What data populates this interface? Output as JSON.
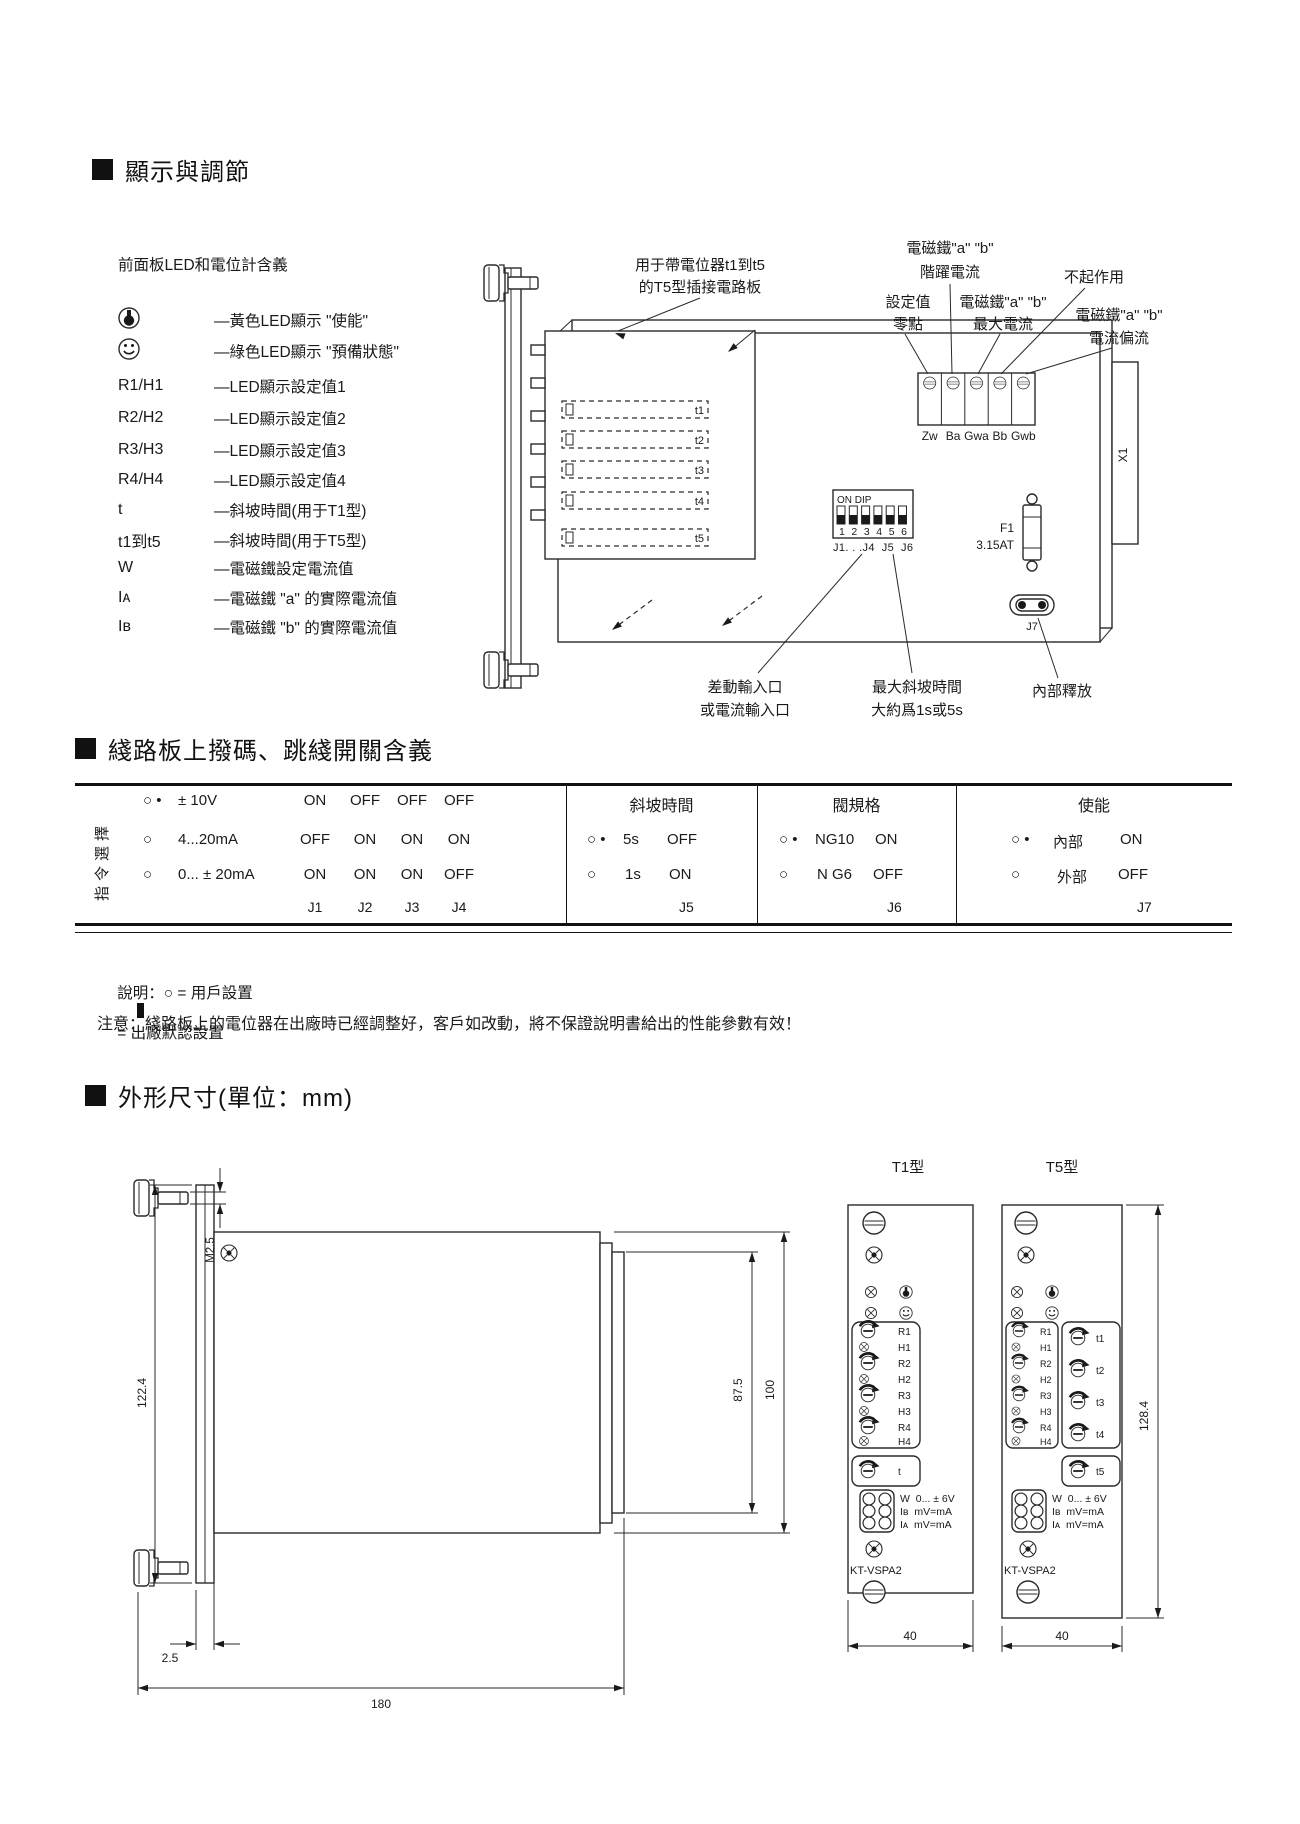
{
  "sections": {
    "display": "顯示與調節",
    "dip": "綫路板上撥碼、跳綫開關含義",
    "dims": "外形尺寸(單位：mm)"
  },
  "legend": {
    "title": "前面板LED和電位計含義",
    "rows": [
      {
        "sym": "",
        "desc": "—黃色LED顯示 \"使能\""
      },
      {
        "sym": "",
        "desc": "—綠色LED顯示 \"預備狀態\""
      },
      {
        "sym": "R1/H1",
        "desc": "—LED顯示設定值1"
      },
      {
        "sym": "R2/H2",
        "desc": "—LED顯示設定值2"
      },
      {
        "sym": "R3/H3",
        "desc": "—LED顯示設定值3"
      },
      {
        "sym": "R4/H4",
        "desc": "—LED顯示設定值4"
      },
      {
        "sym": "t",
        "desc": "—斜坡時間(用于T1型)"
      },
      {
        "sym": "t1到t5",
        "desc": "—斜坡時間(用于T5型)"
      },
      {
        "sym": "W",
        "desc": "—電磁鐵設定電流值"
      },
      {
        "sym": "Iᴀ",
        "desc": "—電磁鐵 \"a\" 的實際電流值"
      },
      {
        "sym": "Iʙ",
        "desc": "—電磁鐵 \"b\" 的實際電流值"
      }
    ]
  },
  "board": {
    "ann": {
      "t5board1": "用于帶電位器t1到t5",
      "t5board2": "的T5型插接電路板",
      "step1": "電磁鐵\"a\" \"b\"",
      "step2": "階躍電流",
      "zero1": "設定值",
      "zero2": "零點",
      "max1": "電磁鐵\"a\" \"b\"",
      "max2": "最大電流",
      "noeffect": "不起作用",
      "bias1": "電磁鐵\"a\" \"b\"",
      "bias2": "電流偏流",
      "input1": "差動輸入口",
      "input2": "或電流輸入口",
      "ramp1": "最大斜坡時間",
      "ramp2": "大約爲1s或5s",
      "release": "內部釋放"
    },
    "pots": [
      "Zw",
      "Ba",
      "Gwa",
      "Bb",
      "Gwb"
    ],
    "dip": {
      "on": "ON DIP",
      "nums": "1 2 3 4 5 6",
      "jumpers": "J1. . .J4  J5  J6"
    },
    "fuse1": "F1",
    "fuse2": "3.15AT",
    "j7": "J7",
    "x1": "X1",
    "tlabels": [
      "t1",
      "t2",
      "t3",
      "t4",
      "t5"
    ]
  },
  "table": {
    "col1": {
      "side": "指令選擇",
      "rows": [
        {
          "m": "○ •",
          "label": "± 10V",
          "v": [
            "ON",
            "OFF",
            "OFF",
            "OFF"
          ]
        },
        {
          "m": "○",
          "label": "4...20mA",
          "v": [
            "OFF",
            "ON",
            "ON",
            "ON"
          ]
        },
        {
          "m": "○",
          "label": "0... ± 20mA",
          "v": [
            "ON",
            "ON",
            "ON",
            "OFF"
          ]
        }
      ],
      "j": [
        "J1",
        "J2",
        "J3",
        "J4"
      ]
    },
    "col2": {
      "header": "斜坡時間",
      "rows": [
        {
          "m": "○ •",
          "label": "5s",
          "v": "OFF"
        },
        {
          "m": "○",
          "label": "1s",
          "v": "ON"
        }
      ],
      "j": "J5"
    },
    "col3": {
      "header": "閥規格",
      "rows": [
        {
          "m": "○ •",
          "label": "NG10",
          "v": "ON"
        },
        {
          "m": "○",
          "label": "N G6",
          "v": "OFF"
        }
      ],
      "j": "J6"
    },
    "col4": {
      "header": "使能",
      "rows": [
        {
          "m": "○ •",
          "label": "內部",
          "v": "ON"
        },
        {
          "m": "○",
          "label": "外部",
          "v": "OFF"
        }
      ],
      "j": "J7"
    }
  },
  "notes": {
    "legend_user": "說明：○ = 用戶設置",
    "legend_default": "= 出廠默認設置",
    "warning": "注意：綫路板上的電位器在出廠時已經調整好，客戶如改動，將不保證說明書給出的性能參數有效！"
  },
  "dims": {
    "side": {
      "h": "122.4",
      "screw": "M2.5",
      "off": "2.5",
      "depth": "180",
      "h1": "87.5",
      "h2": "100"
    },
    "t1": {
      "title": "T1型",
      "width": "40",
      "model": "KT-VSPA2",
      "tpot": "t"
    },
    "t5": {
      "title": "T5型",
      "width": "40",
      "height": "128.4",
      "model": "KT-VSPA2",
      "tpot": "t5"
    },
    "pot_rows": [
      "R1",
      "H1",
      "R2",
      "H2",
      "R3",
      "H3",
      "R4",
      "H4"
    ],
    "t5_pots": [
      "t1",
      "t2",
      "t3",
      "t4"
    ],
    "jacks": [
      "W  0... ± 6V",
      "Iʙ  mV=mA",
      "Iᴀ  mV=mA"
    ]
  }
}
